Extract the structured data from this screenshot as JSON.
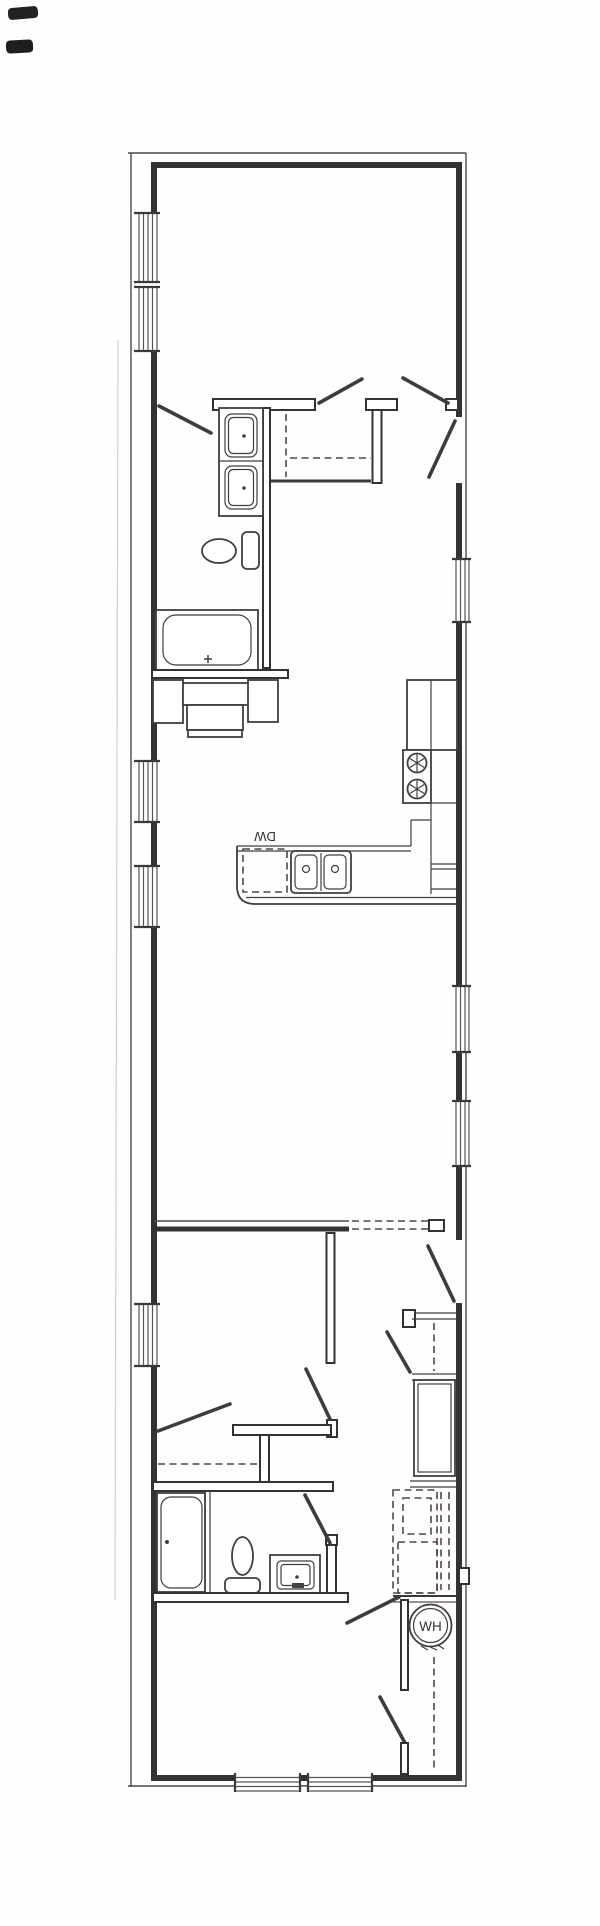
{
  "drawing": {
    "kind": "scanned floor plan",
    "labels": {
      "dishwasher": "DW",
      "water_heater": "WH"
    },
    "colors": {
      "ink": "#3a3a3a",
      "paper": "#fffefd"
    }
  }
}
